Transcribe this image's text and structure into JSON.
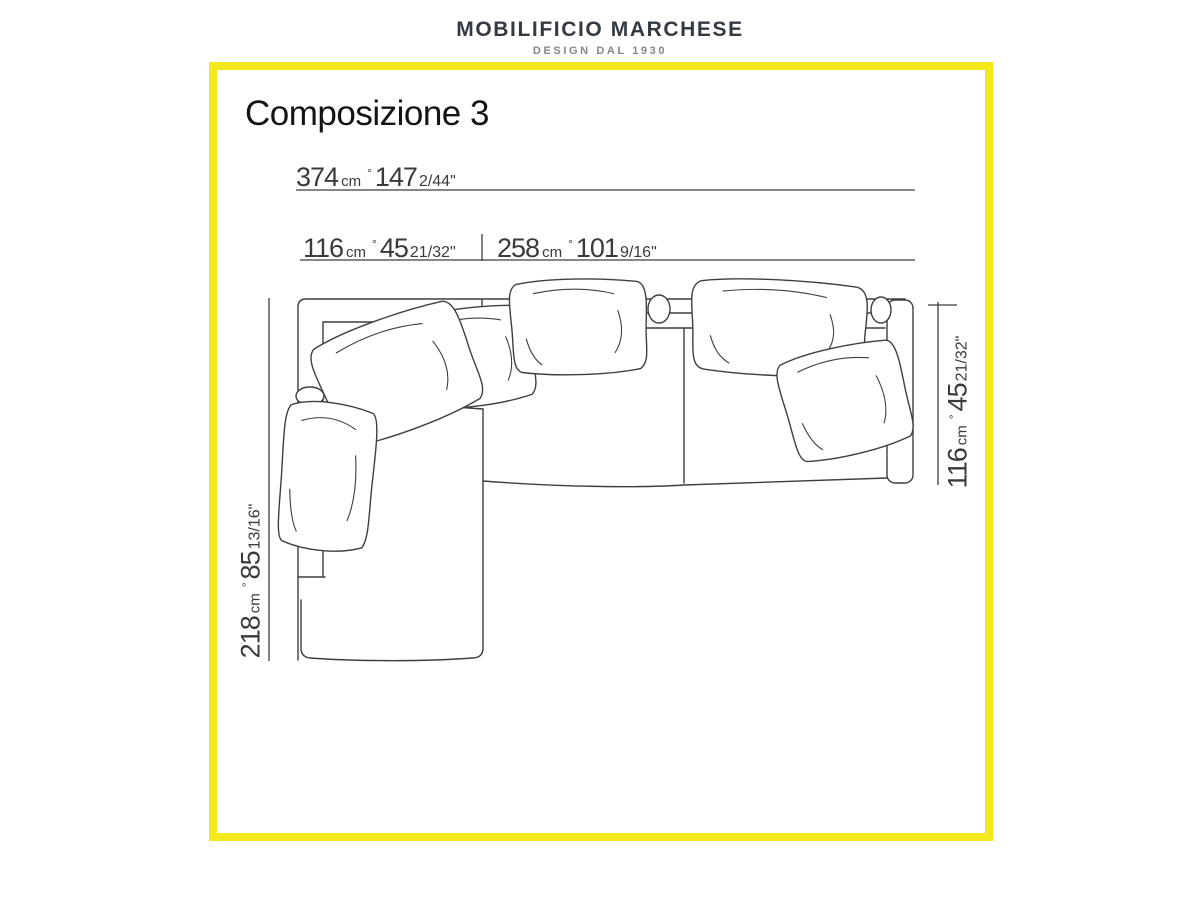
{
  "brand": {
    "name": "MOBILIFICIO MARCHESE",
    "tagline": "DESIGN DAL 1930"
  },
  "page": {
    "title": "Composizione 3"
  },
  "dimensions": {
    "separator": "°",
    "total_width": {
      "cm": "374",
      "cm_unit": "cm",
      "inches": "147",
      "inches_fraction": "2/44\""
    },
    "left_width": {
      "cm": "116",
      "cm_unit": "cm",
      "inches": "45",
      "inches_fraction": "21/32\""
    },
    "right_width": {
      "cm": "258",
      "cm_unit": "cm",
      "inches": "101",
      "inches_fraction": "9/16\""
    },
    "chaise_depth": {
      "cm": "218",
      "cm_unit": "cm",
      "inches": "85",
      "inches_fraction": "13/16\""
    },
    "sofa_depth": {
      "cm": "116",
      "cm_unit": "cm",
      "inches": "45",
      "inches_fraction": "21/32\""
    }
  },
  "colors": {
    "frame_yellow": "#F5E81C",
    "line_color": "#3F3F3F",
    "dim_text": "#3A3A3A",
    "brand_color": "#333A44",
    "tagline_color": "#82878E"
  }
}
